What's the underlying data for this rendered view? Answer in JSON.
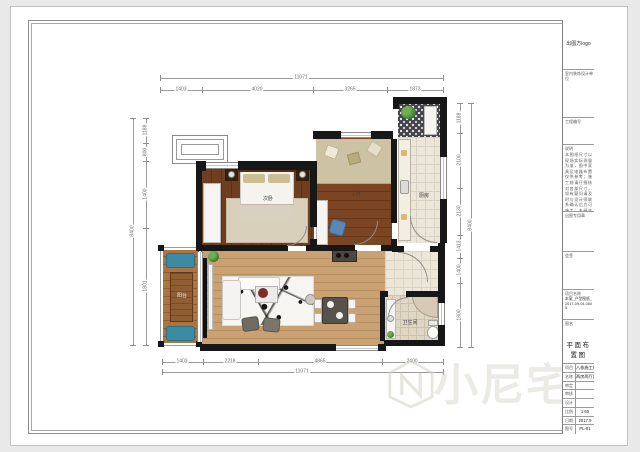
{
  "plan": {
    "rooms": {
      "secondary_bedroom": "次卧",
      "master_bedroom": "主卧",
      "kitchen": "厨房",
      "balcony": "阳台",
      "bathroom": "卫生间"
    },
    "dims": {
      "top_total": "11071",
      "top_segments": [
        "1403",
        "4020",
        "3265",
        "1873"
      ],
      "bottom_total": "11071",
      "bottom_segments": [
        "1403",
        "2218",
        "4865",
        "2400"
      ],
      "left_total": "8400",
      "left_segments": [
        "1188",
        "800",
        "1400",
        "1801"
      ],
      "right_total": "8400",
      "right_segments": [
        "1188",
        "2100",
        "2130",
        "1413",
        "1400",
        "1800"
      ]
    }
  },
  "watermark": {
    "text": "小尼宅配"
  },
  "title_block": {
    "logo_text": "出图方logo",
    "design_unit": "室内装饰设计单位",
    "project_no_label": "工程编号",
    "notes_label": "说明",
    "notes_text": "本图纸尺寸以现场实际测量为准，图中家具及电器布置仅供参考；施工前请仔细核对各部尺寸，如有疑问请及时与设计师联系确认后方可施工；未经许可不得擅自修改本图，图纸版权归设计方所有。",
    "seal_label": "出图专用章",
    "sign_label": "会签",
    "project_name_label": "项目名称",
    "project_name_value": "本案_户型图纸_2017-09-04-0805",
    "drawing_name_label": "图名",
    "drawing_name_value": "平面布置图",
    "rows": [
      {
        "label": "项目",
        "value": "八栋施工图"
      },
      {
        "label": "名称",
        "value": "两房两厅(平面)"
      },
      {
        "label": "审定",
        "value": ""
      },
      {
        "label": "审核",
        "value": ""
      },
      {
        "label": "设计",
        "value": ""
      },
      {
        "label": "比例",
        "value": "1:60"
      },
      {
        "label": "日期",
        "value": "2017.9"
      },
      {
        "label": "图号",
        "value": "PL-01"
      }
    ]
  }
}
